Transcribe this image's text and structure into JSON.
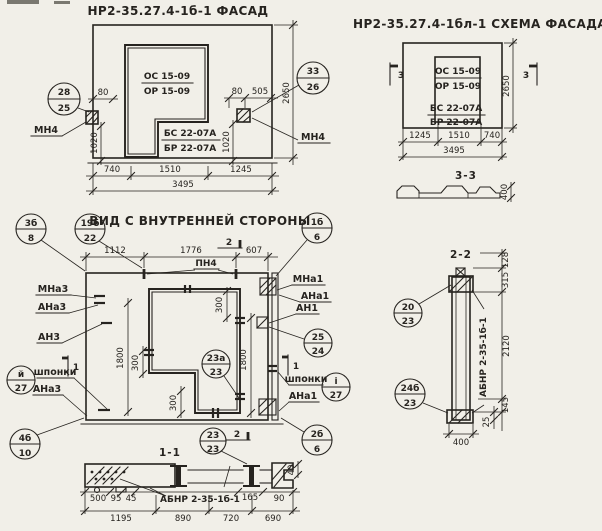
{
  "palette": {
    "paper": "#f1efe8",
    "ink": "#26231f"
  },
  "facade": {
    "title": "НР2-35.27.4-1б-1 ФАСАД",
    "opening_mark_top": "ОС 15-09",
    "opening_mark_bot": "ОР 15-09",
    "sill_mark_top": "БС 22-07А",
    "sill_mark_bot": "БР 22-07А",
    "anchor_left": "МН4",
    "anchor_right": "МН4",
    "callout_left": {
      "top": "28",
      "bot": "25"
    },
    "callout_right": {
      "top": "33",
      "bot": "26"
    },
    "dims": {
      "d80l": "80",
      "d80r": "80",
      "d505": "505",
      "d1020l": "1020",
      "d1020r": "1020",
      "d2650": "2650",
      "d740": "740",
      "d1510": "1510",
      "d1245": "1245",
      "total": "3495"
    }
  },
  "schema": {
    "title": "НР2-35.27.4-1бл-1 СХЕМА ФАСАДА",
    "opening_mark_top": "ОС 15-09",
    "opening_mark_bot": "ОР 15-09",
    "sill_mark_top": "БС 22-07А",
    "sill_mark_bot": "БР 22-07А",
    "section_mark_left": "3",
    "section_mark_right": "3",
    "dims": {
      "d2650": "2650",
      "d1245": "1245",
      "d1510": "1510",
      "d740": "740",
      "total": "3495"
    }
  },
  "section33": {
    "title": "3-3",
    "dims": {
      "d400": "400"
    }
  },
  "innerview": {
    "title": "ВИД С ВНУТРЕННЕЙ СТОРОНЫ",
    "pn4": "ПН4",
    "flag_top": "2",
    "flag_bottom": "2",
    "flag_left": "1",
    "flag_right": "1",
    "labels_left": {
      "mna3": "МНа3",
      "ana3": "АНа3",
      "an3": "АН3",
      "shponki": "шпонки",
      "ana3b": "АНа3"
    },
    "labels_right": {
      "mna1": "МНа1",
      "ana1": "АНа1",
      "an1": "АН1",
      "shponki": "шпонки",
      "ana1b": "АНа1"
    },
    "callouts": {
      "c3b": {
        "top": "3б",
        "bot": "8"
      },
      "c19b": {
        "top": "19б",
        "bot": "22"
      },
      "c1b": {
        "top": "1б",
        "bot": "6"
      },
      "c25": {
        "top": "25",
        "bot": "24"
      },
      "c23a": {
        "top": "23а",
        "bot": "23"
      },
      "c23": {
        "top": "23",
        "bot": "23"
      },
      "ci_left": {
        "top": "й",
        "bot": "27"
      },
      "ci_right": {
        "top": "і",
        "bot": "27"
      },
      "c4b": {
        "top": "4б",
        "bot": "10"
      },
      "c2b": {
        "top": "2б",
        "bot": "6"
      }
    },
    "dims": {
      "d1112": "1112",
      "d1776": "1776",
      "d607": "607",
      "d1800l": "1800",
      "d1800r": "1800",
      "d300a": "300",
      "d300b": "300",
      "d300c": "300"
    }
  },
  "section11": {
    "title": "1-1",
    "beam_mark": "АБНР 2-35-1б-1",
    "dims": {
      "d500": "500",
      "d95": "95",
      "d45": "45",
      "d165": "165",
      "d90": "90",
      "d40": "40",
      "d1195": "1195",
      "d890": "890",
      "d720": "720",
      "d690": "690"
    }
  },
  "section22": {
    "title": "2-2",
    "beam_mark": "АБНР 2-35-1б-1",
    "callouts": {
      "c20": {
        "top": "20",
        "bot": "23"
      },
      "c24b": {
        "top": "24б",
        "bot": "23"
      }
    },
    "dims": {
      "d128": "128",
      "d315": "315",
      "d2120": "2120",
      "d145": "145",
      "d25": "25",
      "d400": "400"
    }
  }
}
